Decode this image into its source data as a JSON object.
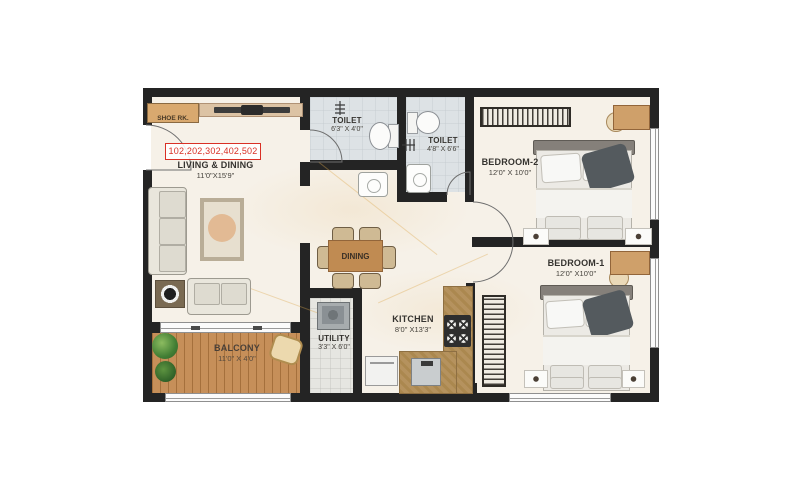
{
  "unit_ribbon": "102,202,302,402,502",
  "rooms": {
    "living": {
      "name": "LIVING & DINING",
      "dims": "11'0\"X15'9\""
    },
    "balcony": {
      "name": "BALCONY",
      "dims": "11'0\" X 4'0\""
    },
    "toilet1": {
      "name": "TOILET",
      "dims": "6'3\" X 4'0\""
    },
    "toilet2": {
      "name": "TOILET",
      "dims": "4'8\" X 6'6\""
    },
    "bedroom2": {
      "name": "BEDROOM-2",
      "dims": "12'0\" X 10'0\""
    },
    "bedroom1": {
      "name": "BEDROOM-1",
      "dims": "12'0\" X10'0\""
    },
    "kitchen": {
      "name": "KITCHEN",
      "dims": "8'0\" X13'3\""
    },
    "utility": {
      "name": "UTILITY",
      "dims": "3'3\" X 6'0\""
    },
    "dining": {
      "name": "DINING"
    },
    "shoe_rack": {
      "name": "SHOE RK."
    }
  },
  "colors": {
    "wall": "#242424",
    "floor": "#f6f1e8",
    "accent_red": "#d93025",
    "wood": "#c08b52",
    "deck": "#c68f59"
  }
}
